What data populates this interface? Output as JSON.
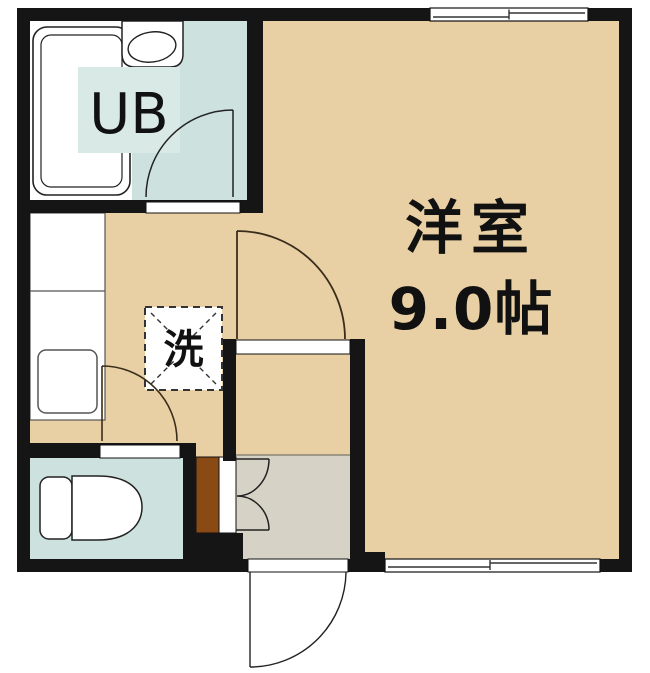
{
  "labels": {
    "unit_bath": "UB",
    "main_room_name": "洋室",
    "main_room_size": "9.0帖",
    "washer": "洗"
  },
  "colors": {
    "floor_tan": "#e8d0a4",
    "wet_room_teal": "#cde2de",
    "ub_label_teal": "#d9eae6",
    "entry_gray": "#d6d2c6",
    "cabinet_brown": "#8a4a15",
    "wall_black": "#151515",
    "arc_brown": "#3a2d1c",
    "line_dark": "#222222"
  }
}
